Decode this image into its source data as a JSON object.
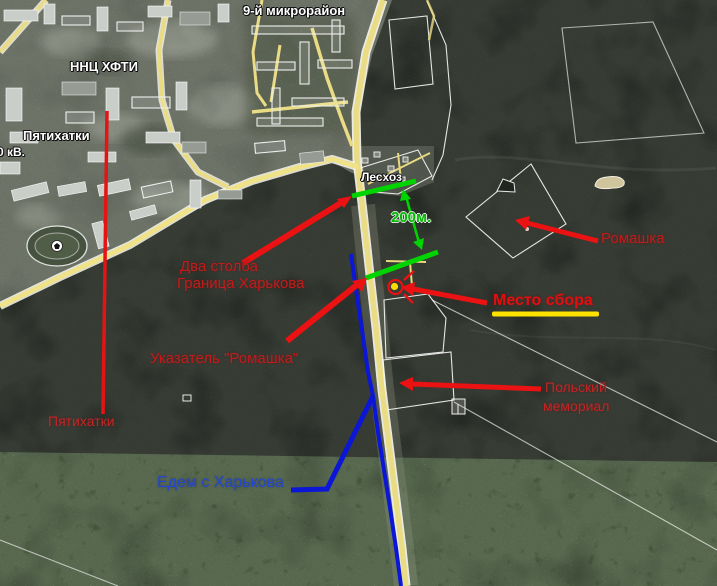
{
  "map_labels": {
    "microdistrict": "9-й микрорайон",
    "nnc": "ННЦ ХФТИ",
    "pyatikhatki": "Пятихатки",
    "kv": "0 кВ.",
    "leskhoz": "Лесхоз"
  },
  "annotations": {
    "distance": "200м.",
    "romashka": "Ромашка",
    "two_pillars_line1": "Два столба",
    "two_pillars_line2": "Граница Харькова",
    "meeting_point": "Место сбора",
    "sign_romashka": "Указатель \"Ромашка\"",
    "polish_line1": "Польский",
    "polish_line2": "мемориал",
    "pyatikhatki_red": "Пятихатки",
    "from_kharkov": "Едем с Харькова"
  },
  "colors": {
    "annotation_red": "#e01010",
    "annotation_green": "#00d400",
    "annotation_blue": "#0b16d6",
    "road_yellow": "#eadc85",
    "highlight_yellow": "#ffe200"
  }
}
